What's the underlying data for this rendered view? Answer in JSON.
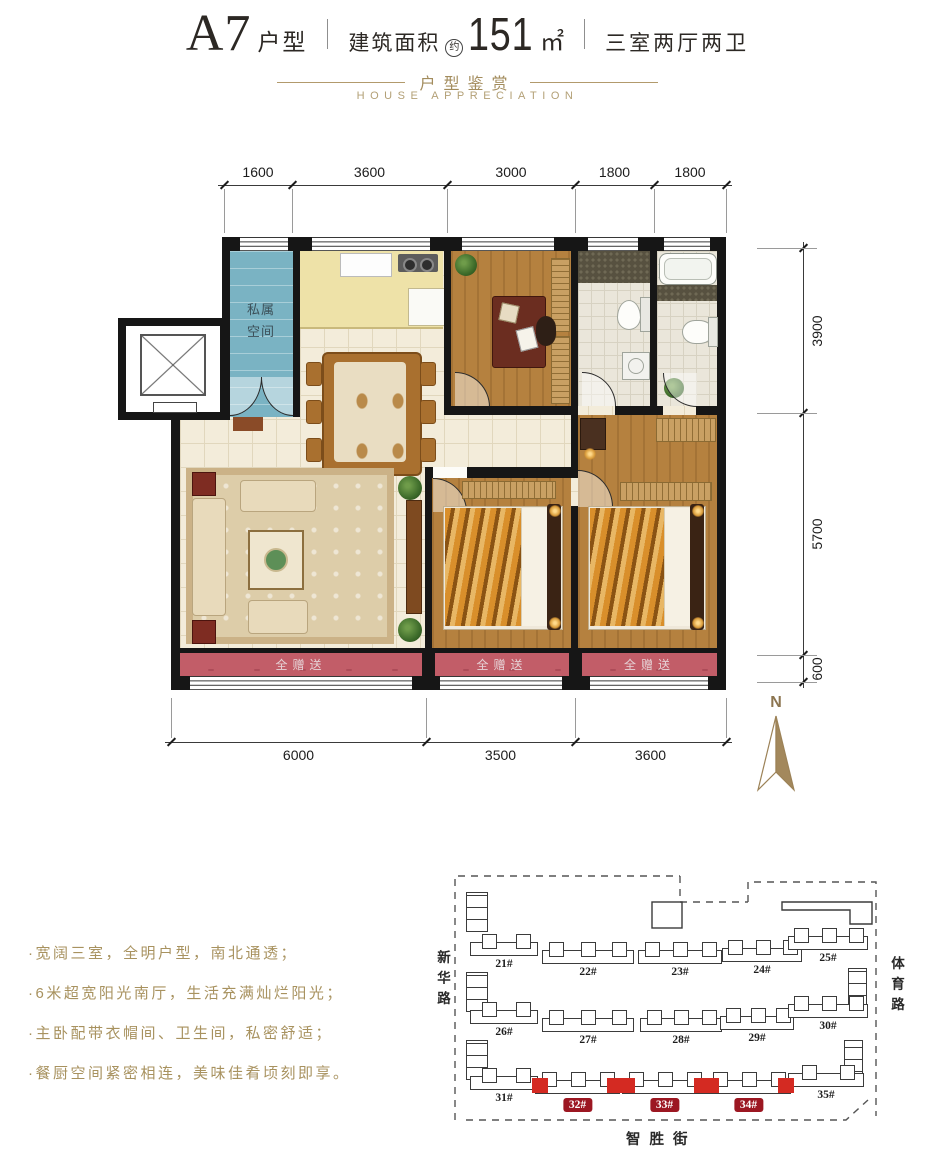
{
  "header": {
    "unit_code": "A7",
    "unit_type_suffix": "户型",
    "area_label": "建筑面积",
    "area_approx_badge": "约",
    "area_value": "151",
    "area_unit": "㎡",
    "rooms_summary": "三室两厅两卫",
    "subtitle_cn": "户型鉴赏",
    "subtitle_en": "HOUSE APPRECIATION"
  },
  "floorplan": {
    "dim_top": [
      "1600",
      "3600",
      "3000",
      "1800",
      "1800"
    ],
    "dim_bottom": [
      "6000",
      "3500",
      "3600"
    ],
    "dim_right": [
      "3900",
      "5700",
      "600"
    ],
    "private_space_label": "私属空间",
    "gift_label": "全赠送",
    "compass_label": "N"
  },
  "features": [
    "·宽阔三室，全明户型，南北通透；",
    "·6米超宽阳光南厅，生活充满灿烂阳光；",
    "·主卧配带衣帽间、卫生间，私密舒适；",
    "·餐厨空间紧密相连，美味佳肴顷刻即享。"
  ],
  "siteplan": {
    "road_left": "新华路",
    "road_right": "体育路",
    "road_bottom": "智胜街",
    "buildings": [
      {
        "label": "21#",
        "highlight": false
      },
      {
        "label": "22#",
        "highlight": false
      },
      {
        "label": "23#",
        "highlight": false
      },
      {
        "label": "24#",
        "highlight": false
      },
      {
        "label": "25#",
        "highlight": false
      },
      {
        "label": "26#",
        "highlight": false
      },
      {
        "label": "27#",
        "highlight": false
      },
      {
        "label": "28#",
        "highlight": false
      },
      {
        "label": "29#",
        "highlight": false
      },
      {
        "label": "30#",
        "highlight": false
      },
      {
        "label": "31#",
        "highlight": false
      },
      {
        "label": "32#",
        "highlight": true
      },
      {
        "label": "33#",
        "highlight": true
      },
      {
        "label": "34#",
        "highlight": true
      },
      {
        "label": "35#",
        "highlight": false
      }
    ]
  },
  "colors": {
    "accent_gold": "#a8925f",
    "private_space_blue": "#7ab3c3",
    "gift_balcony_red": "#c25d68",
    "highlight_building_red": "#d42a22",
    "badge_red": "#9c1722",
    "wall_black": "#161616",
    "wood_floor": "#b5813f"
  }
}
